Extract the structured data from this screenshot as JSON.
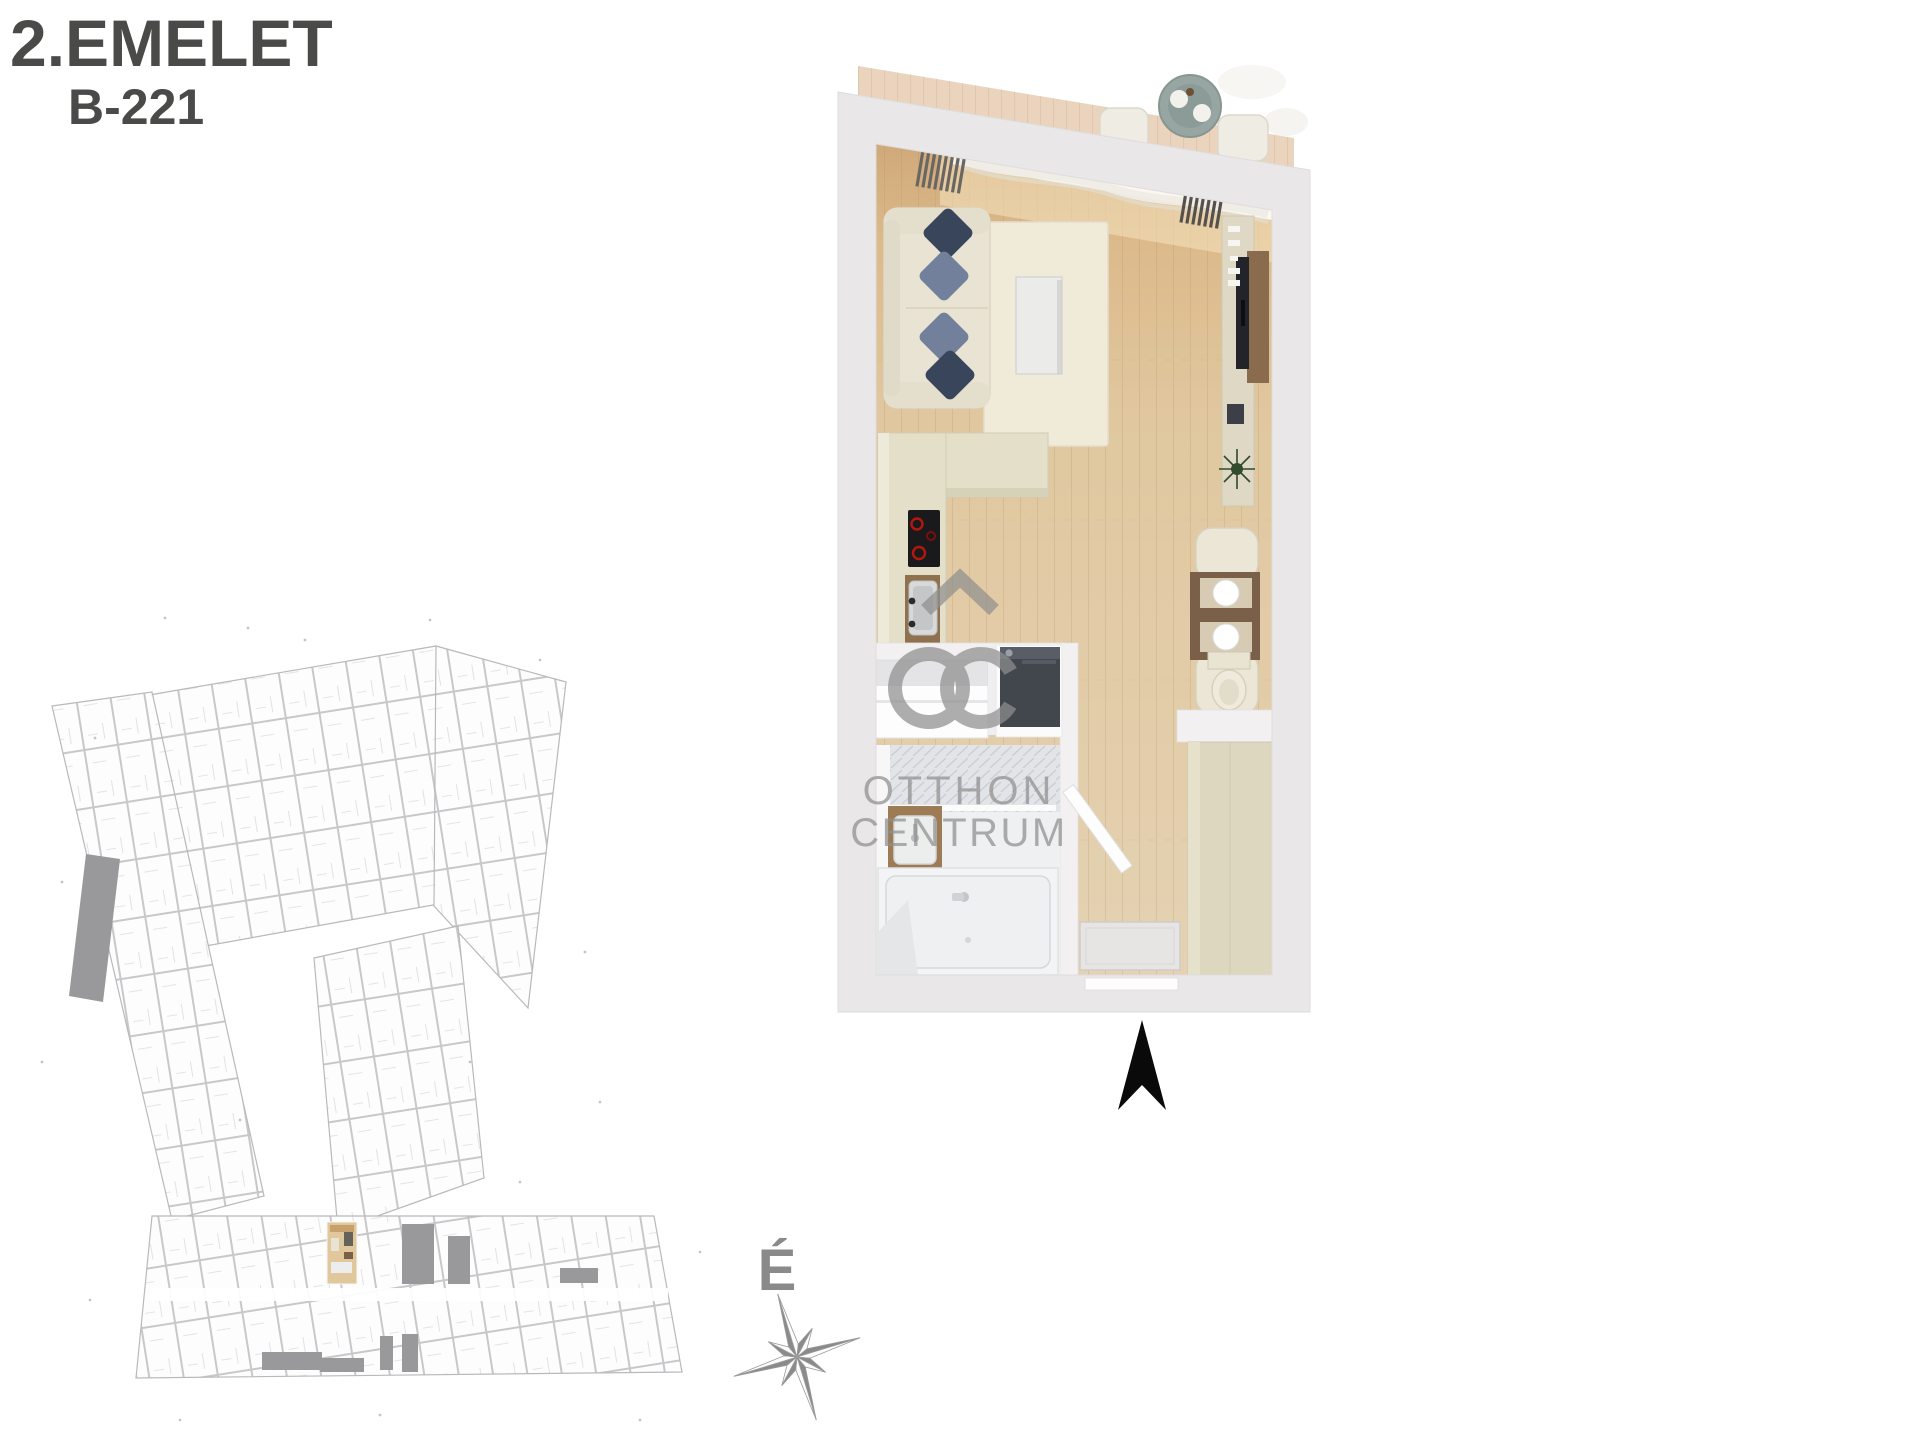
{
  "title": {
    "floor_label": "2.EMELET",
    "unit_label": "B-221"
  },
  "watermark": {
    "brand_line1": "OTTHON",
    "brand_line2": "CENTRUM"
  },
  "compass": {
    "north_label": "É"
  },
  "colors": {
    "title_text": "#4a4a49",
    "wall_fill": "#eae7e8",
    "inner_wall": "#f2f0f1",
    "wood_floor_dark": "#cfa97a",
    "wood_floor_light": "#e4d2b2",
    "balcony_deck": "#ead4bd",
    "rug": "#f0ead9",
    "sofa": "#e9e3d3",
    "pillow_dark": "#39455a",
    "pillow_light": "#72809b",
    "coffee_table": "#ebebe9",
    "kitchen_counter": "#e3dfc9",
    "cooktop": "#1a1a1c",
    "appliance_dark": "#42464d",
    "sideboard": "#ded8c4",
    "tv_panel_wood": "#8a6b4e",
    "dining_table_wood": "#7a5f49",
    "wardrobe": "#ddd7bf",
    "bath_white": "#f2f4f5",
    "tile_wall": "#e2e4e8",
    "watermark_gray": "#8f8f8f",
    "compass_gray": "#8a8a8a",
    "north_arrow": "#0a0a0a",
    "siteplan_line": "#c8c8cb",
    "siteplan_dark": "#99989b",
    "siteplan_highlight_floor": "#e0c79c"
  }
}
